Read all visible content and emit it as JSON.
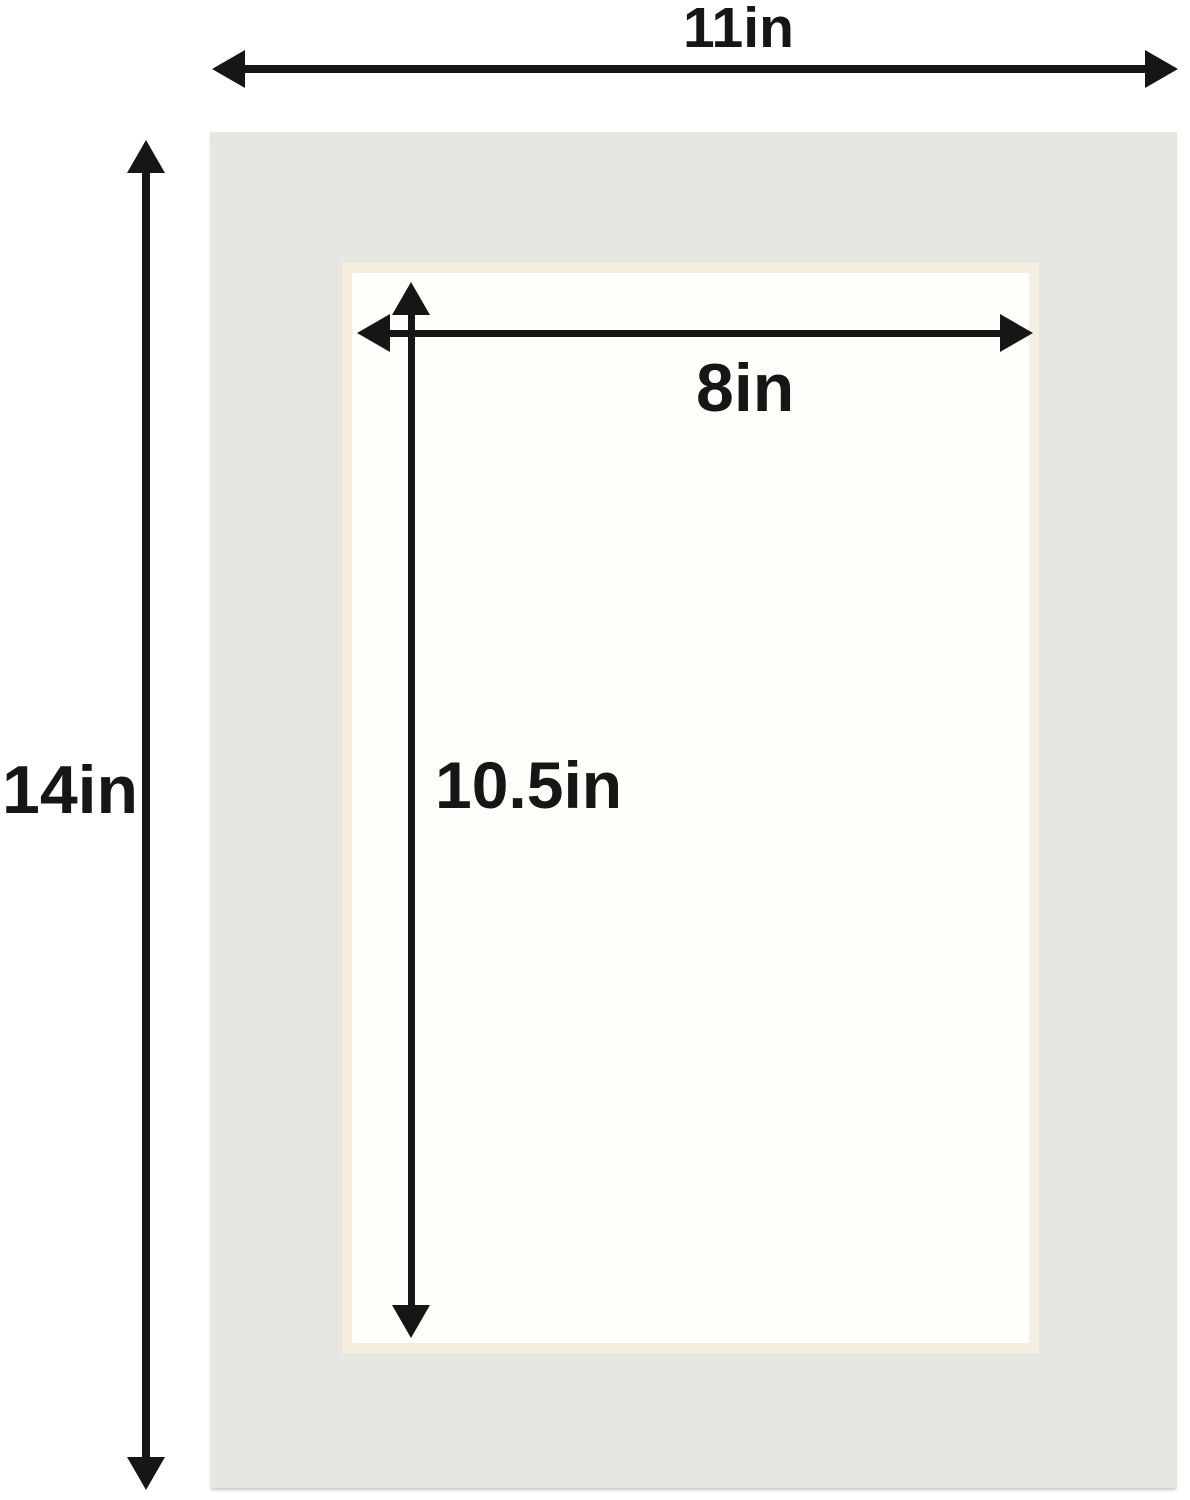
{
  "figure": {
    "type": "picture-mat-dimension-diagram",
    "labels": {
      "outer_width": "11in",
      "outer_height": "14in",
      "opening_width": "8in",
      "opening_height": "10.5in"
    },
    "measurements": {
      "outer_width_in": 11,
      "outer_height_in": 14,
      "opening_width_in": 8,
      "opening_height_in": 10.5,
      "unit": "in"
    }
  },
  "colors": {
    "background": "#ffffff",
    "mat": "#e6e7e1",
    "bevel": "#f6efe0",
    "opening": "#fffefb",
    "dimension": "#161616"
  }
}
